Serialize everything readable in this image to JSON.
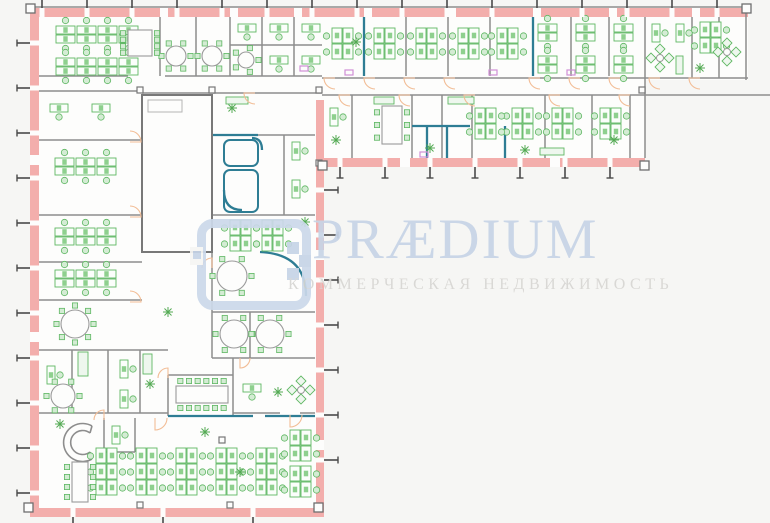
{
  "watermark": {
    "brand": "PRÆDIUM",
    "tagline": "КОММЕРЧЕСКАЯ НЕДВИЖИМОСТЬ",
    "brand_color": "#c7d4e6",
    "tagline_color": "#d7d6d3",
    "icon_color": "#ccd9ea"
  },
  "palette": {
    "bg": "#f6f6f4",
    "floor": "#fdfdfc",
    "wall_pink": "#f3aeac",
    "wall_gray": "#8d8d8d",
    "wall_dark": "#4a4a4a",
    "partition_teal": "#2e7d94",
    "furniture_green": "#5fb763",
    "furniture_fill": "#fbfefb",
    "chair_fill": "#d4ecd4",
    "monitor_fill": "#8ed08e",
    "door_arc": "#f2bd96",
    "accent_magenta": "#d08fd6",
    "cabinet_fill": "#eef7ee",
    "column_gray": "#777777"
  },
  "plan": {
    "floor_polygon": "30,8 748,8 748,80 645,80 645,167 324,167 324,517 30,517",
    "pink_walls": [
      [
        30,
        8,
        718,
        9
      ],
      [
        30,
        17,
        9,
        500
      ],
      [
        39,
        508,
        285,
        9
      ],
      [
        316,
        100,
        8,
        408
      ],
      [
        322,
        158,
        323,
        9
      ]
    ],
    "window_gaps": [
      [
        160,
        8,
        8,
        9
      ],
      [
        230,
        8,
        8,
        9
      ],
      [
        294,
        8,
        8,
        9
      ],
      [
        364,
        8,
        8,
        9
      ],
      [
        448,
        8,
        8,
        9
      ],
      [
        533,
        8,
        8,
        9
      ],
      [
        609,
        8,
        8,
        9
      ],
      [
        692,
        8,
        8,
        9
      ],
      [
        400,
        158,
        10,
        9
      ],
      [
        550,
        158,
        10,
        9
      ],
      [
        316,
        250,
        8,
        10
      ],
      [
        316,
        440,
        8,
        10
      ],
      [
        30,
        155,
        9,
        10
      ],
      [
        30,
        332,
        9,
        10
      ]
    ],
    "gray_lines": [
      [
        30,
        7,
        748,
        7
      ],
      [
        746,
        7,
        746,
        80
      ],
      [
        645,
        78,
        748,
        78
      ],
      [
        645,
        78,
        645,
        95
      ],
      [
        322,
        95,
        770,
        95
      ],
      [
        39,
        76,
        128,
        76
      ],
      [
        165,
        76,
        322,
        76
      ],
      [
        322,
        78,
        645,
        78
      ],
      [
        39,
        91,
        142,
        91
      ],
      [
        142,
        93,
        322,
        93
      ],
      [
        160,
        17,
        160,
        76
      ],
      [
        196,
        17,
        196,
        76
      ],
      [
        230,
        17,
        230,
        76
      ],
      [
        262,
        17,
        262,
        76
      ],
      [
        294,
        17,
        294,
        76
      ],
      [
        406,
        17,
        406,
        76
      ],
      [
        448,
        17,
        448,
        76
      ],
      [
        490,
        17,
        490,
        76
      ],
      [
        571,
        17,
        571,
        76
      ],
      [
        609,
        17,
        609,
        76
      ],
      [
        645,
        17,
        645,
        78
      ],
      [
        692,
        17,
        692,
        78
      ],
      [
        719,
        17,
        719,
        78
      ],
      [
        230,
        45,
        322,
        45
      ],
      [
        352,
        95,
        352,
        158
      ],
      [
        412,
        95,
        412,
        158
      ],
      [
        442,
        95,
        442,
        158
      ],
      [
        472,
        95,
        472,
        158
      ],
      [
        545,
        95,
        545,
        158
      ],
      [
        592,
        95,
        592,
        158
      ],
      [
        630,
        95,
        630,
        158
      ],
      [
        645,
        95,
        645,
        158
      ],
      [
        142,
        118,
        212,
        118
      ],
      [
        39,
        140,
        142,
        140
      ],
      [
        39,
        215,
        142,
        215
      ],
      [
        39,
        262,
        142,
        262
      ],
      [
        39,
        300,
        142,
        300
      ],
      [
        39,
        350,
        168,
        350
      ],
      [
        39,
        413,
        168,
        413
      ],
      [
        72,
        350,
        72,
        413
      ],
      [
        108,
        350,
        108,
        413
      ],
      [
        140,
        350,
        140,
        413
      ],
      [
        212,
        252,
        212,
        358
      ],
      [
        212,
        312,
        315,
        312
      ],
      [
        250,
        312,
        250,
        358
      ],
      [
        212,
        358,
        315,
        358
      ],
      [
        168,
        375,
        233,
        375
      ],
      [
        168,
        375,
        168,
        416
      ],
      [
        233,
        358,
        233,
        416
      ],
      [
        233,
        413,
        280,
        413
      ],
      [
        300,
        413,
        315,
        413
      ],
      [
        212,
        135,
        315,
        135
      ],
      [
        212,
        215,
        315,
        215
      ],
      [
        284,
        135,
        284,
        215
      ],
      [
        104,
        418,
        104,
        452
      ],
      [
        104,
        452,
        135,
        452
      ],
      [
        135,
        418,
        135,
        452
      ]
    ],
    "teal_lines": [
      [
        364,
        17,
        364,
        76
      ],
      [
        533,
        17,
        533,
        76
      ],
      [
        412,
        126,
        470,
        126
      ],
      [
        427,
        126,
        427,
        158
      ],
      [
        447,
        126,
        447,
        158
      ],
      [
        505,
        126,
        505,
        158
      ],
      [
        168,
        416,
        253,
        416
      ],
      [
        265,
        416,
        315,
        416
      ],
      [
        213,
        135,
        258,
        135
      ]
    ],
    "teal_rects": [
      [
        224,
        140,
        34,
        26
      ],
      [
        224,
        170,
        34,
        42
      ]
    ],
    "teal_paths": [
      "M260,252 Q306,254 306,296",
      "M224,190 Q224,210 242,210",
      "M252,138 Q262,138 262,150"
    ],
    "gray_paths": [
      "M92,426 A19,19 0 1 0 92,459",
      "M90,433 A12,12 0 1 0 90,452",
      "M92,426 L90,433",
      "M92,459 L90,452"
    ],
    "core_rect": [
      142,
      95,
      70,
      157
    ],
    "core_inner": [
      148,
      100,
      34,
      12
    ],
    "benches": [
      [
        332,
        28
      ],
      [
        374,
        28
      ],
      [
        416,
        28
      ],
      [
        458,
        28
      ],
      [
        497,
        28
      ],
      [
        700,
        22
      ],
      [
        512,
        108
      ],
      [
        552,
        108
      ],
      [
        600,
        108
      ],
      [
        475,
        108
      ],
      [
        230,
        220
      ],
      [
        262,
        220
      ],
      [
        96,
        448,
        3
      ],
      [
        136,
        448,
        3
      ],
      [
        176,
        448,
        3
      ],
      [
        216,
        448,
        3
      ],
      [
        256,
        448,
        3
      ],
      [
        290,
        430
      ],
      [
        290,
        466
      ]
    ],
    "grids": [
      [
        56,
        26,
        4
      ],
      [
        56,
        58,
        4
      ],
      [
        538,
        24,
        1
      ],
      [
        538,
        56,
        1
      ],
      [
        576,
        24,
        1
      ],
      [
        576,
        56,
        1
      ],
      [
        614,
        24,
        1
      ],
      [
        614,
        56,
        1
      ],
      [
        55,
        158,
        3
      ],
      [
        55,
        228,
        3
      ],
      [
        55,
        270,
        3
      ]
    ],
    "singles": [
      [
        50,
        104,
        "h"
      ],
      [
        92,
        104,
        "h"
      ],
      [
        238,
        24,
        "h"
      ],
      [
        270,
        24,
        "h"
      ],
      [
        302,
        24,
        "h"
      ],
      [
        270,
        56,
        "h"
      ],
      [
        302,
        56,
        "h"
      ],
      [
        330,
        108,
        "v"
      ],
      [
        292,
        142,
        "v"
      ],
      [
        292,
        180,
        "v"
      ],
      [
        120,
        360,
        "v"
      ],
      [
        120,
        390,
        "v"
      ],
      [
        47,
        366,
        "v"
      ],
      [
        112,
        426,
        "v"
      ],
      [
        243,
        384,
        "h"
      ],
      [
        652,
        24,
        "v"
      ],
      [
        676,
        24,
        "v"
      ]
    ],
    "round_tables": [
      [
        176,
        56,
        10,
        6
      ],
      [
        212,
        56,
        10,
        6
      ],
      [
        246,
        60,
        8,
        5
      ],
      [
        232,
        276,
        15,
        6
      ],
      [
        234,
        334,
        14,
        6
      ],
      [
        270,
        334,
        14,
        6
      ],
      [
        75,
        324,
        14,
        8
      ],
      [
        63,
        396,
        12,
        6
      ]
    ],
    "rect_tables": [
      [
        128,
        30,
        24,
        26,
        "v",
        8
      ],
      [
        382,
        106,
        20,
        38,
        "v",
        6
      ],
      [
        176,
        386,
        52,
        17,
        "h",
        12
      ],
      [
        72,
        462,
        16,
        40,
        "v",
        8
      ]
    ],
    "lounges": [
      [
        727,
        52
      ],
      [
        660,
        58
      ],
      [
        301,
        390
      ]
    ],
    "plants": [
      [
        336,
        140
      ],
      [
        430,
        148
      ],
      [
        525,
        150
      ],
      [
        614,
        140
      ],
      [
        232,
        108
      ],
      [
        60,
        424
      ],
      [
        150,
        384
      ],
      [
        205,
        432
      ],
      [
        240,
        472
      ],
      [
        278,
        392
      ],
      [
        356,
        42
      ],
      [
        700,
        68
      ],
      [
        168,
        312
      ],
      [
        305,
        222
      ]
    ],
    "cabinets": [
      [
        226,
        97,
        22,
        7
      ],
      [
        448,
        97,
        26,
        7
      ],
      [
        540,
        148,
        24,
        7
      ],
      [
        78,
        352,
        10,
        24
      ],
      [
        143,
        354,
        9,
        20
      ],
      [
        676,
        56,
        7,
        18
      ],
      [
        374,
        97,
        20,
        7
      ]
    ],
    "accents": [
      [
        345,
        70,
        8,
        5
      ],
      [
        489,
        70,
        8,
        5
      ],
      [
        567,
        70,
        8,
        5
      ],
      [
        420,
        152,
        8,
        5
      ],
      [
        300,
        66,
        8,
        5
      ]
    ],
    "columns": [
      [
        319,
        90
      ],
      [
        642,
        90
      ],
      [
        140,
        90
      ],
      [
        212,
        90
      ],
      [
        319,
        163
      ],
      [
        222,
        440
      ],
      [
        140,
        505
      ],
      [
        230,
        505
      ]
    ],
    "corner_blocks": [
      [
        26,
        4
      ],
      [
        742,
        4
      ],
      [
        24,
        503
      ],
      [
        314,
        503
      ],
      [
        640,
        161
      ],
      [
        318,
        161
      ]
    ],
    "door_arcs": [
      [
        335,
        78,
        11,
        1
      ],
      [
        375,
        78,
        11,
        1
      ],
      [
        415,
        78,
        11,
        1
      ],
      [
        455,
        78,
        11,
        1
      ],
      [
        540,
        78,
        11,
        1
      ],
      [
        580,
        78,
        11,
        1
      ],
      [
        620,
        78,
        11,
        1
      ],
      [
        660,
        78,
        11,
        1
      ],
      [
        700,
        78,
        11,
        1
      ],
      [
        350,
        95,
        11,
        1
      ],
      [
        410,
        95,
        11,
        1
      ],
      [
        475,
        95,
        11,
        1
      ],
      [
        560,
        95,
        11,
        1
      ],
      [
        630,
        95,
        11,
        1
      ],
      [
        130,
        142,
        11,
        3
      ],
      [
        130,
        217,
        11,
        3
      ],
      [
        130,
        302,
        11,
        3
      ],
      [
        155,
        418,
        12,
        0
      ],
      [
        290,
        415,
        12,
        0
      ],
      [
        212,
        268,
        10,
        2
      ],
      [
        255,
        93,
        11,
        1
      ],
      [
        104,
        420,
        10,
        2
      ],
      [
        168,
        378,
        10,
        2
      ],
      [
        240,
        358,
        10,
        0
      ]
    ],
    "ticks": [
      {
        "axis": "x",
        "pos": [
          42,
          87,
          132,
          177,
          222,
          267,
          312,
          357,
          402,
          447,
          492,
          537,
          582,
          627,
          672,
          717
        ],
        "from": 0,
        "to": 8,
        "wall": [
          8,
          9
        ],
        "cap": false
      },
      {
        "axis": "y",
        "pos": [
          43,
          88,
          133,
          178,
          223,
          268,
          313,
          358,
          403,
          448,
          493
        ],
        "from": 30,
        "to": 17,
        "wall": [
          30,
          9
        ],
        "cap": true
      },
      {
        "axis": "y",
        "pos": [
          190,
          235,
          280,
          325,
          370,
          415,
          460
        ],
        "from": 324,
        "to": 338,
        "wall": [
          315,
          9
        ],
        "cap": true
      },
      {
        "axis": "x",
        "pos": [
          73,
          163,
          253
        ],
        "from": 517,
        "to": 523,
        "wall": [
          508,
          9
        ],
        "cap": false
      },
      {
        "axis": "x",
        "pos": [
          340,
          385,
          430,
          475,
          520,
          565,
          610
        ],
        "from": 167,
        "to": 178,
        "wall": [
          158,
          9
        ],
        "cap": true
      }
    ]
  }
}
